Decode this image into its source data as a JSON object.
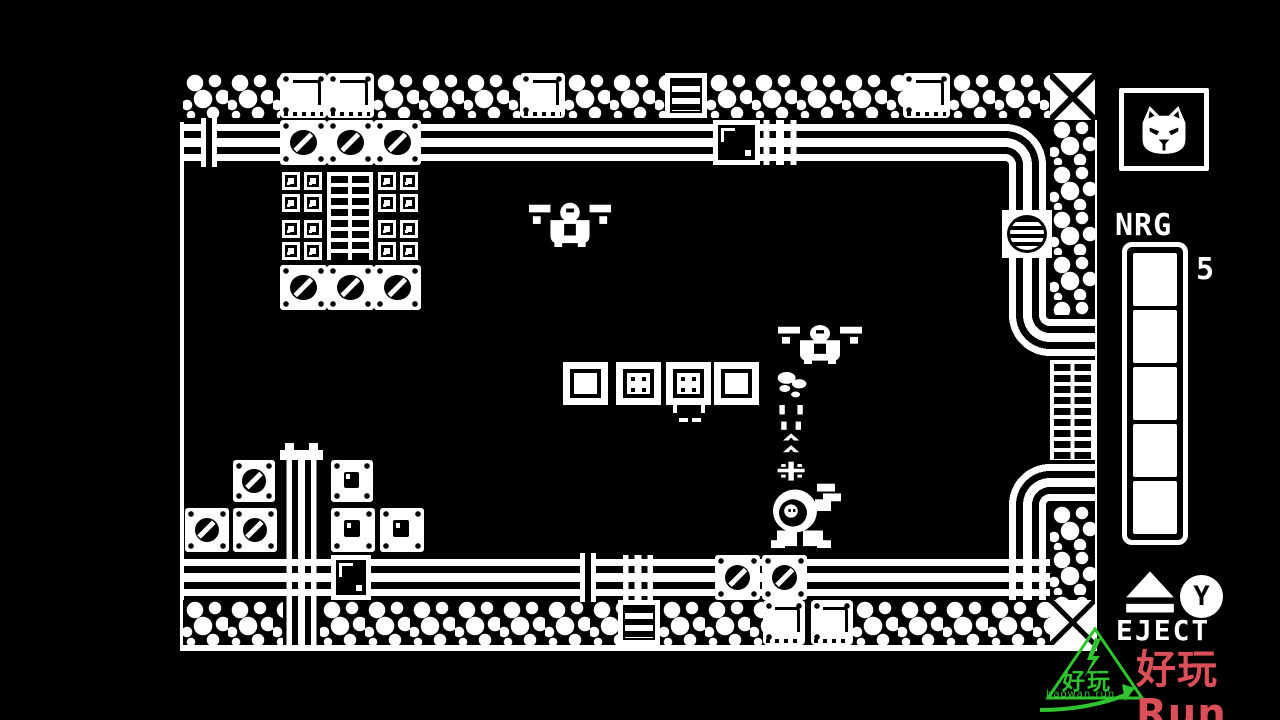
{
  "hud": {
    "cat_icon": "angry-cat-face",
    "nrg_label": "NRG",
    "nrg_value": "5",
    "nrg_segments_total": 5,
    "nrg_segments_filled": 5,
    "y_button_label": "Y",
    "eject_label": "EJECT"
  },
  "watermarks": {
    "green": {
      "logo": "lightning-triangle",
      "text": "好玩",
      "url": "haowan.run",
      "color": "#2fc42f"
    },
    "red": {
      "text": "好玩Run",
      "url": "www.haowan.run",
      "color": "#da4f58"
    }
  },
  "colors": {
    "foreground": "#ffffff",
    "background": "#000000"
  },
  "playfield": {
    "tiles": [
      [
        "line",
        0,
        62,
        4,
        529
      ],
      [
        "line",
        913,
        60,
        4,
        531
      ],
      [
        "line",
        0,
        585,
        917,
        6
      ],
      [
        "rock",
        3,
        13,
        97,
        45
      ],
      [
        "plate",
        100,
        13,
        47,
        45
      ],
      [
        "plate",
        147,
        13,
        47,
        45
      ],
      [
        "rock",
        194,
        13,
        146,
        45
      ],
      [
        "plate",
        340,
        13,
        45,
        45
      ],
      [
        "rock",
        385,
        13,
        100,
        45
      ],
      [
        "ladder",
        485,
        13,
        42,
        45
      ],
      [
        "rock",
        527,
        13,
        196,
        45
      ],
      [
        "plate",
        723,
        13,
        47,
        45
      ],
      [
        "rock",
        770,
        13,
        100,
        45
      ],
      [
        "xtile",
        870,
        13,
        45,
        47
      ],
      [
        "hpipe",
        4,
        60,
        821,
        45
      ],
      [
        "elbow-ws",
        825,
        60,
        45,
        45
      ],
      [
        "vbar",
        21,
        58,
        16,
        49
      ],
      [
        "crate",
        100,
        60,
        47,
        45
      ],
      [
        "crate",
        147,
        60,
        47,
        45
      ],
      [
        "crate",
        194,
        60,
        47,
        45
      ],
      [
        "darkcrate",
        533,
        60,
        47,
        45
      ],
      [
        "junctionv",
        580,
        60,
        40,
        45
      ],
      [
        "rock",
        870,
        60,
        45,
        195
      ],
      [
        "vpipe",
        825,
        105,
        45,
        150
      ],
      [
        "elbow-ne",
        825,
        255,
        45,
        45
      ],
      [
        "hpipe",
        870,
        255,
        45,
        45
      ],
      [
        "grate",
        870,
        300,
        45,
        100
      ],
      [
        "hpipe",
        870,
        400,
        45,
        45
      ],
      [
        "elbow-ed",
        825,
        400,
        45,
        45
      ],
      [
        "vpipe",
        825,
        445,
        45,
        50
      ],
      [
        "rock",
        870,
        445,
        45,
        95
      ],
      [
        "junctionv",
        825,
        495,
        45,
        45
      ],
      [
        "xtile",
        870,
        540,
        45,
        45
      ],
      [
        "vent",
        822,
        150,
        50,
        48
      ],
      [
        "smallblock",
        102,
        112,
        18,
        18
      ],
      [
        "smallblock",
        124,
        112,
        18,
        18
      ],
      [
        "smallblock",
        198,
        112,
        18,
        18
      ],
      [
        "smallblock",
        220,
        112,
        18,
        18
      ],
      [
        "smallblock",
        102,
        134,
        18,
        18
      ],
      [
        "smallblock",
        124,
        134,
        18,
        18
      ],
      [
        "smallblock",
        198,
        134,
        18,
        18
      ],
      [
        "smallblock",
        220,
        134,
        18,
        18
      ],
      [
        "smallblock",
        102,
        160,
        18,
        18
      ],
      [
        "smallblock",
        124,
        160,
        18,
        18
      ],
      [
        "smallblock",
        198,
        160,
        18,
        18
      ],
      [
        "smallblock",
        220,
        160,
        18,
        18
      ],
      [
        "smallblock",
        102,
        182,
        18,
        18
      ],
      [
        "smallblock",
        124,
        182,
        18,
        18
      ],
      [
        "smallblock",
        198,
        182,
        18,
        18
      ],
      [
        "smallblock",
        220,
        182,
        18,
        18
      ],
      [
        "grate",
        147,
        112,
        46,
        88
      ],
      [
        "crate",
        100,
        205,
        47,
        45
      ],
      [
        "crate",
        147,
        205,
        47,
        45
      ],
      [
        "crate",
        194,
        205,
        47,
        45
      ],
      [
        "blockplain",
        383,
        302,
        45,
        43
      ],
      [
        "blockdots",
        436,
        302,
        45,
        43
      ],
      [
        "blockdots",
        486,
        302,
        45,
        43
      ],
      [
        "blockplain",
        534,
        302,
        45,
        43
      ],
      [
        "rock",
        3,
        540,
        100,
        45
      ],
      [
        "rock",
        140,
        540,
        298,
        45
      ],
      [
        "ladder",
        438,
        540,
        42,
        45
      ],
      [
        "rock",
        480,
        540,
        103,
        45
      ],
      [
        "plate",
        583,
        540,
        42,
        45
      ],
      [
        "plate",
        631,
        540,
        42,
        45
      ],
      [
        "rock",
        673,
        540,
        197,
        45
      ],
      [
        "vpipe",
        103,
        398,
        37,
        187
      ],
      [
        "cap",
        100,
        390,
        43,
        10
      ],
      [
        "crate",
        53,
        400,
        42,
        42
      ],
      [
        "crate",
        5,
        448,
        44,
        44
      ],
      [
        "crate",
        53,
        448,
        44,
        44
      ],
      [
        "crate2",
        151,
        400,
        42,
        42
      ],
      [
        "crate2",
        151,
        448,
        44,
        44
      ],
      [
        "crate2",
        200,
        448,
        44,
        44
      ],
      [
        "hpipe",
        4,
        495,
        821,
        45
      ],
      [
        "junctionv",
        103,
        495,
        37,
        45
      ],
      [
        "darkcrate",
        151,
        495,
        40,
        45
      ],
      [
        "vbar",
        400,
        493,
        16,
        49
      ],
      [
        "junctionv",
        440,
        495,
        36,
        45
      ],
      [
        "crate",
        535,
        495,
        45,
        45
      ],
      [
        "crate",
        582,
        495,
        45,
        45
      ]
    ],
    "sprites": [
      {
        "type": "fly",
        "x": 347,
        "y": 137,
        "w": 86,
        "h": 50
      },
      {
        "type": "fly",
        "x": 596,
        "y": 260,
        "w": 88,
        "h": 44
      },
      {
        "type": "drip",
        "x": 487,
        "y": 342,
        "w": 45,
        "h": 26
      },
      {
        "type": "trail",
        "x": 594,
        "y": 312,
        "w": 36,
        "h": 118
      },
      {
        "type": "mech",
        "x": 585,
        "y": 412,
        "w": 80,
        "h": 78
      }
    ]
  }
}
